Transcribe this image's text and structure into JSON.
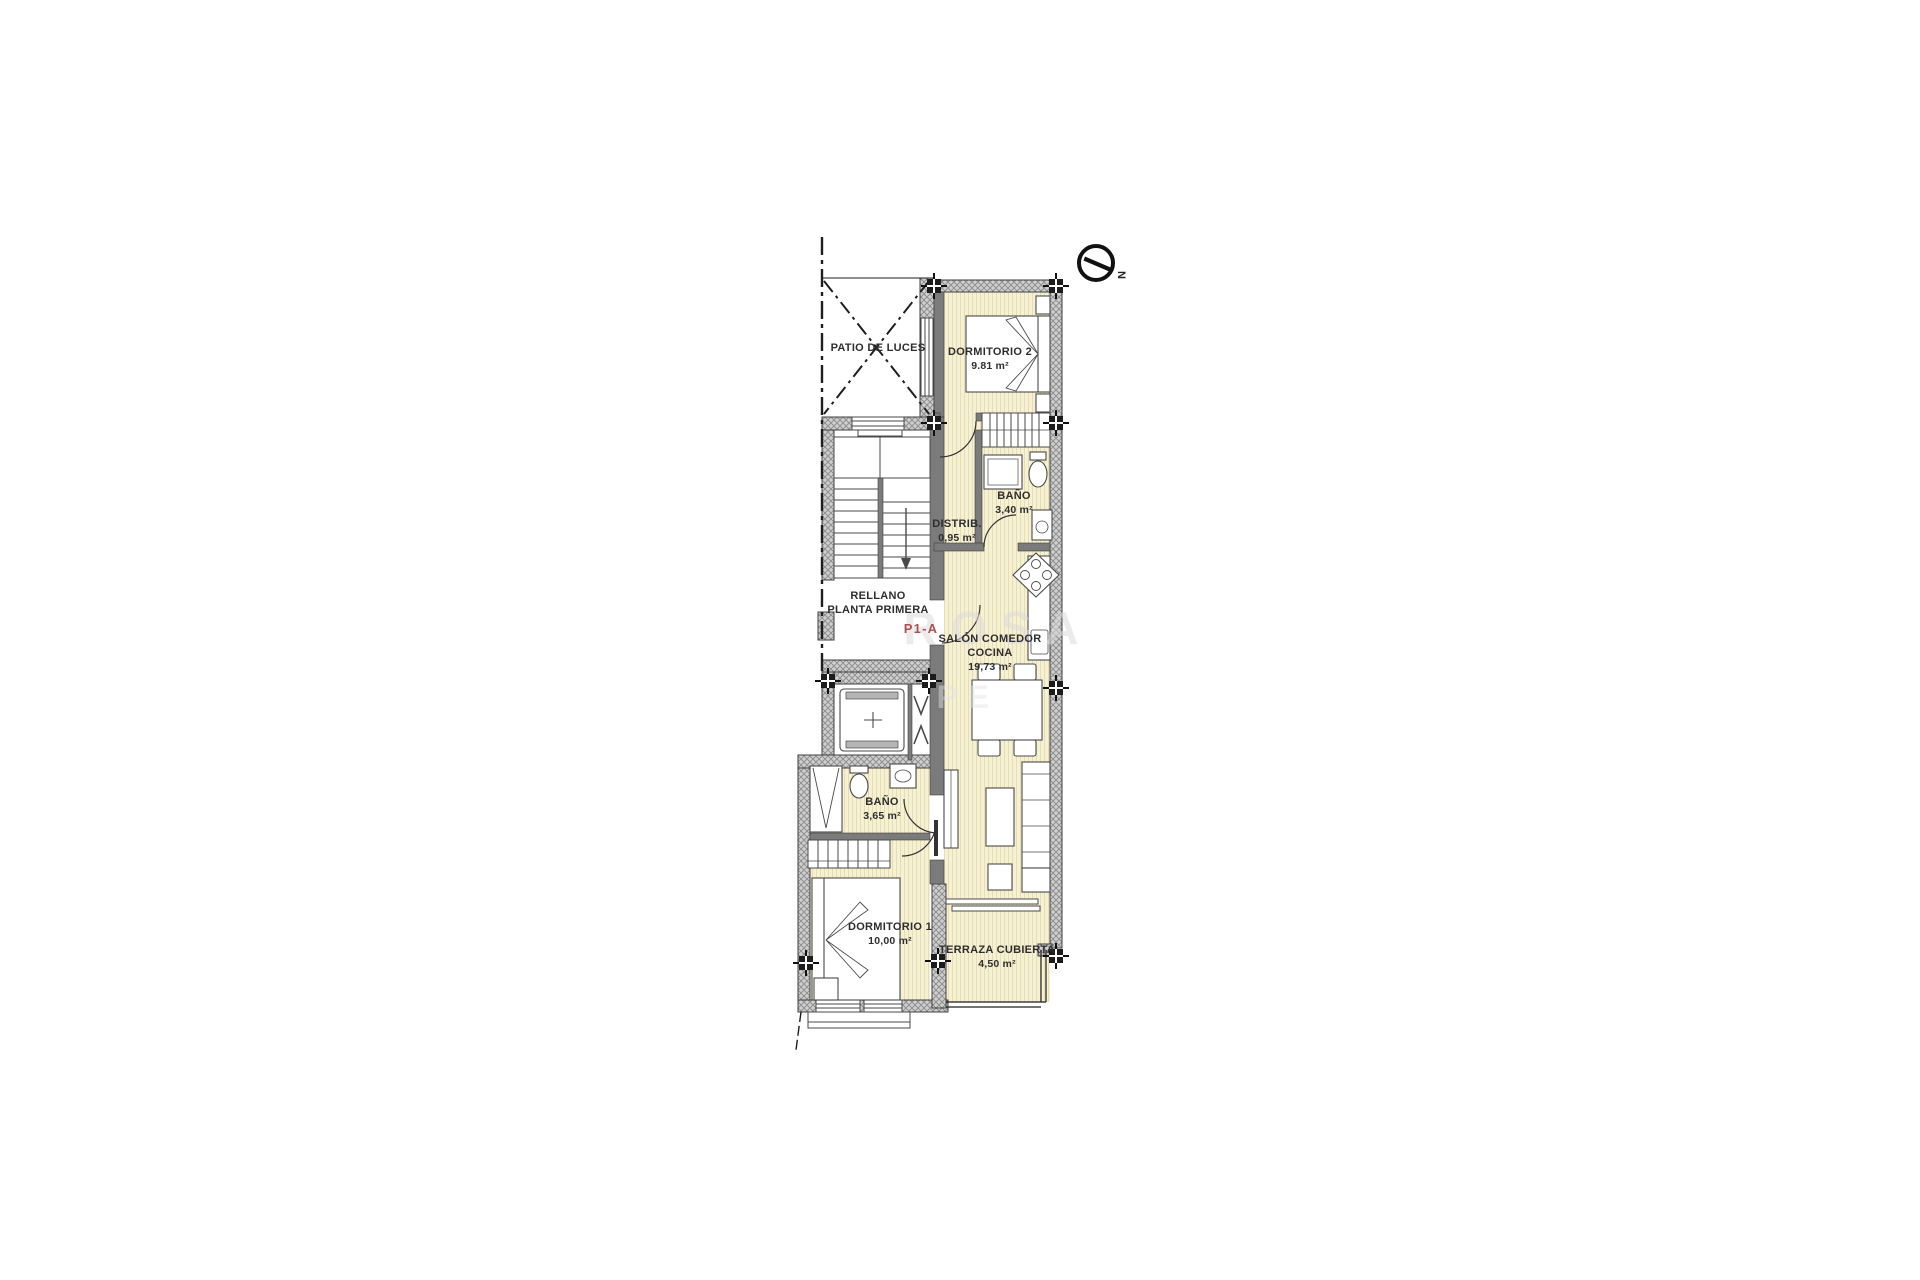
{
  "plan": {
    "rooms": [
      {
        "id": "patio",
        "name": "PATIO DE LUCES",
        "area": ""
      },
      {
        "id": "dormitorio2",
        "name": "DORMITORIO 2",
        "area": "9.81 m²"
      },
      {
        "id": "bano_planta",
        "name": "BAÑO",
        "area": "3,40 m²"
      },
      {
        "id": "distribuidor",
        "name": "DISTRIB.",
        "area": "0,95 m²"
      },
      {
        "id": "rellano",
        "name": "RELLANO",
        "name2": "PLANTA PRIMERA",
        "area": ""
      },
      {
        "id": "salon",
        "name": "SALÓN COMEDOR",
        "name2": "COCINA",
        "area": "19,73 m²"
      },
      {
        "id": "bano_2",
        "name": "BAÑO",
        "area": "3,65 m²"
      },
      {
        "id": "dormitorio1",
        "name": "DORMITORIO 1",
        "area": "10,00 m²"
      },
      {
        "id": "terraza",
        "name": "TERRAZA CUBIERTA",
        "area": "4,50 m²"
      }
    ],
    "unit_label": "P1-A",
    "compass": {
      "north": "N"
    },
    "watermark": {
      "line1": "ROSA",
      "line2": "PE"
    },
    "colors": {
      "floor": "#f7f1d4",
      "floor_stripe": "#e6ddb4",
      "wall_hatch": "#cfcfcf",
      "wall_hatch_line": "#8f8f8f",
      "partition": "#7b7b7b",
      "line": "#3f3f3f",
      "accent_red": "#b05050",
      "text": "#2e2e2e",
      "watermark": "#dcdcdc"
    }
  }
}
